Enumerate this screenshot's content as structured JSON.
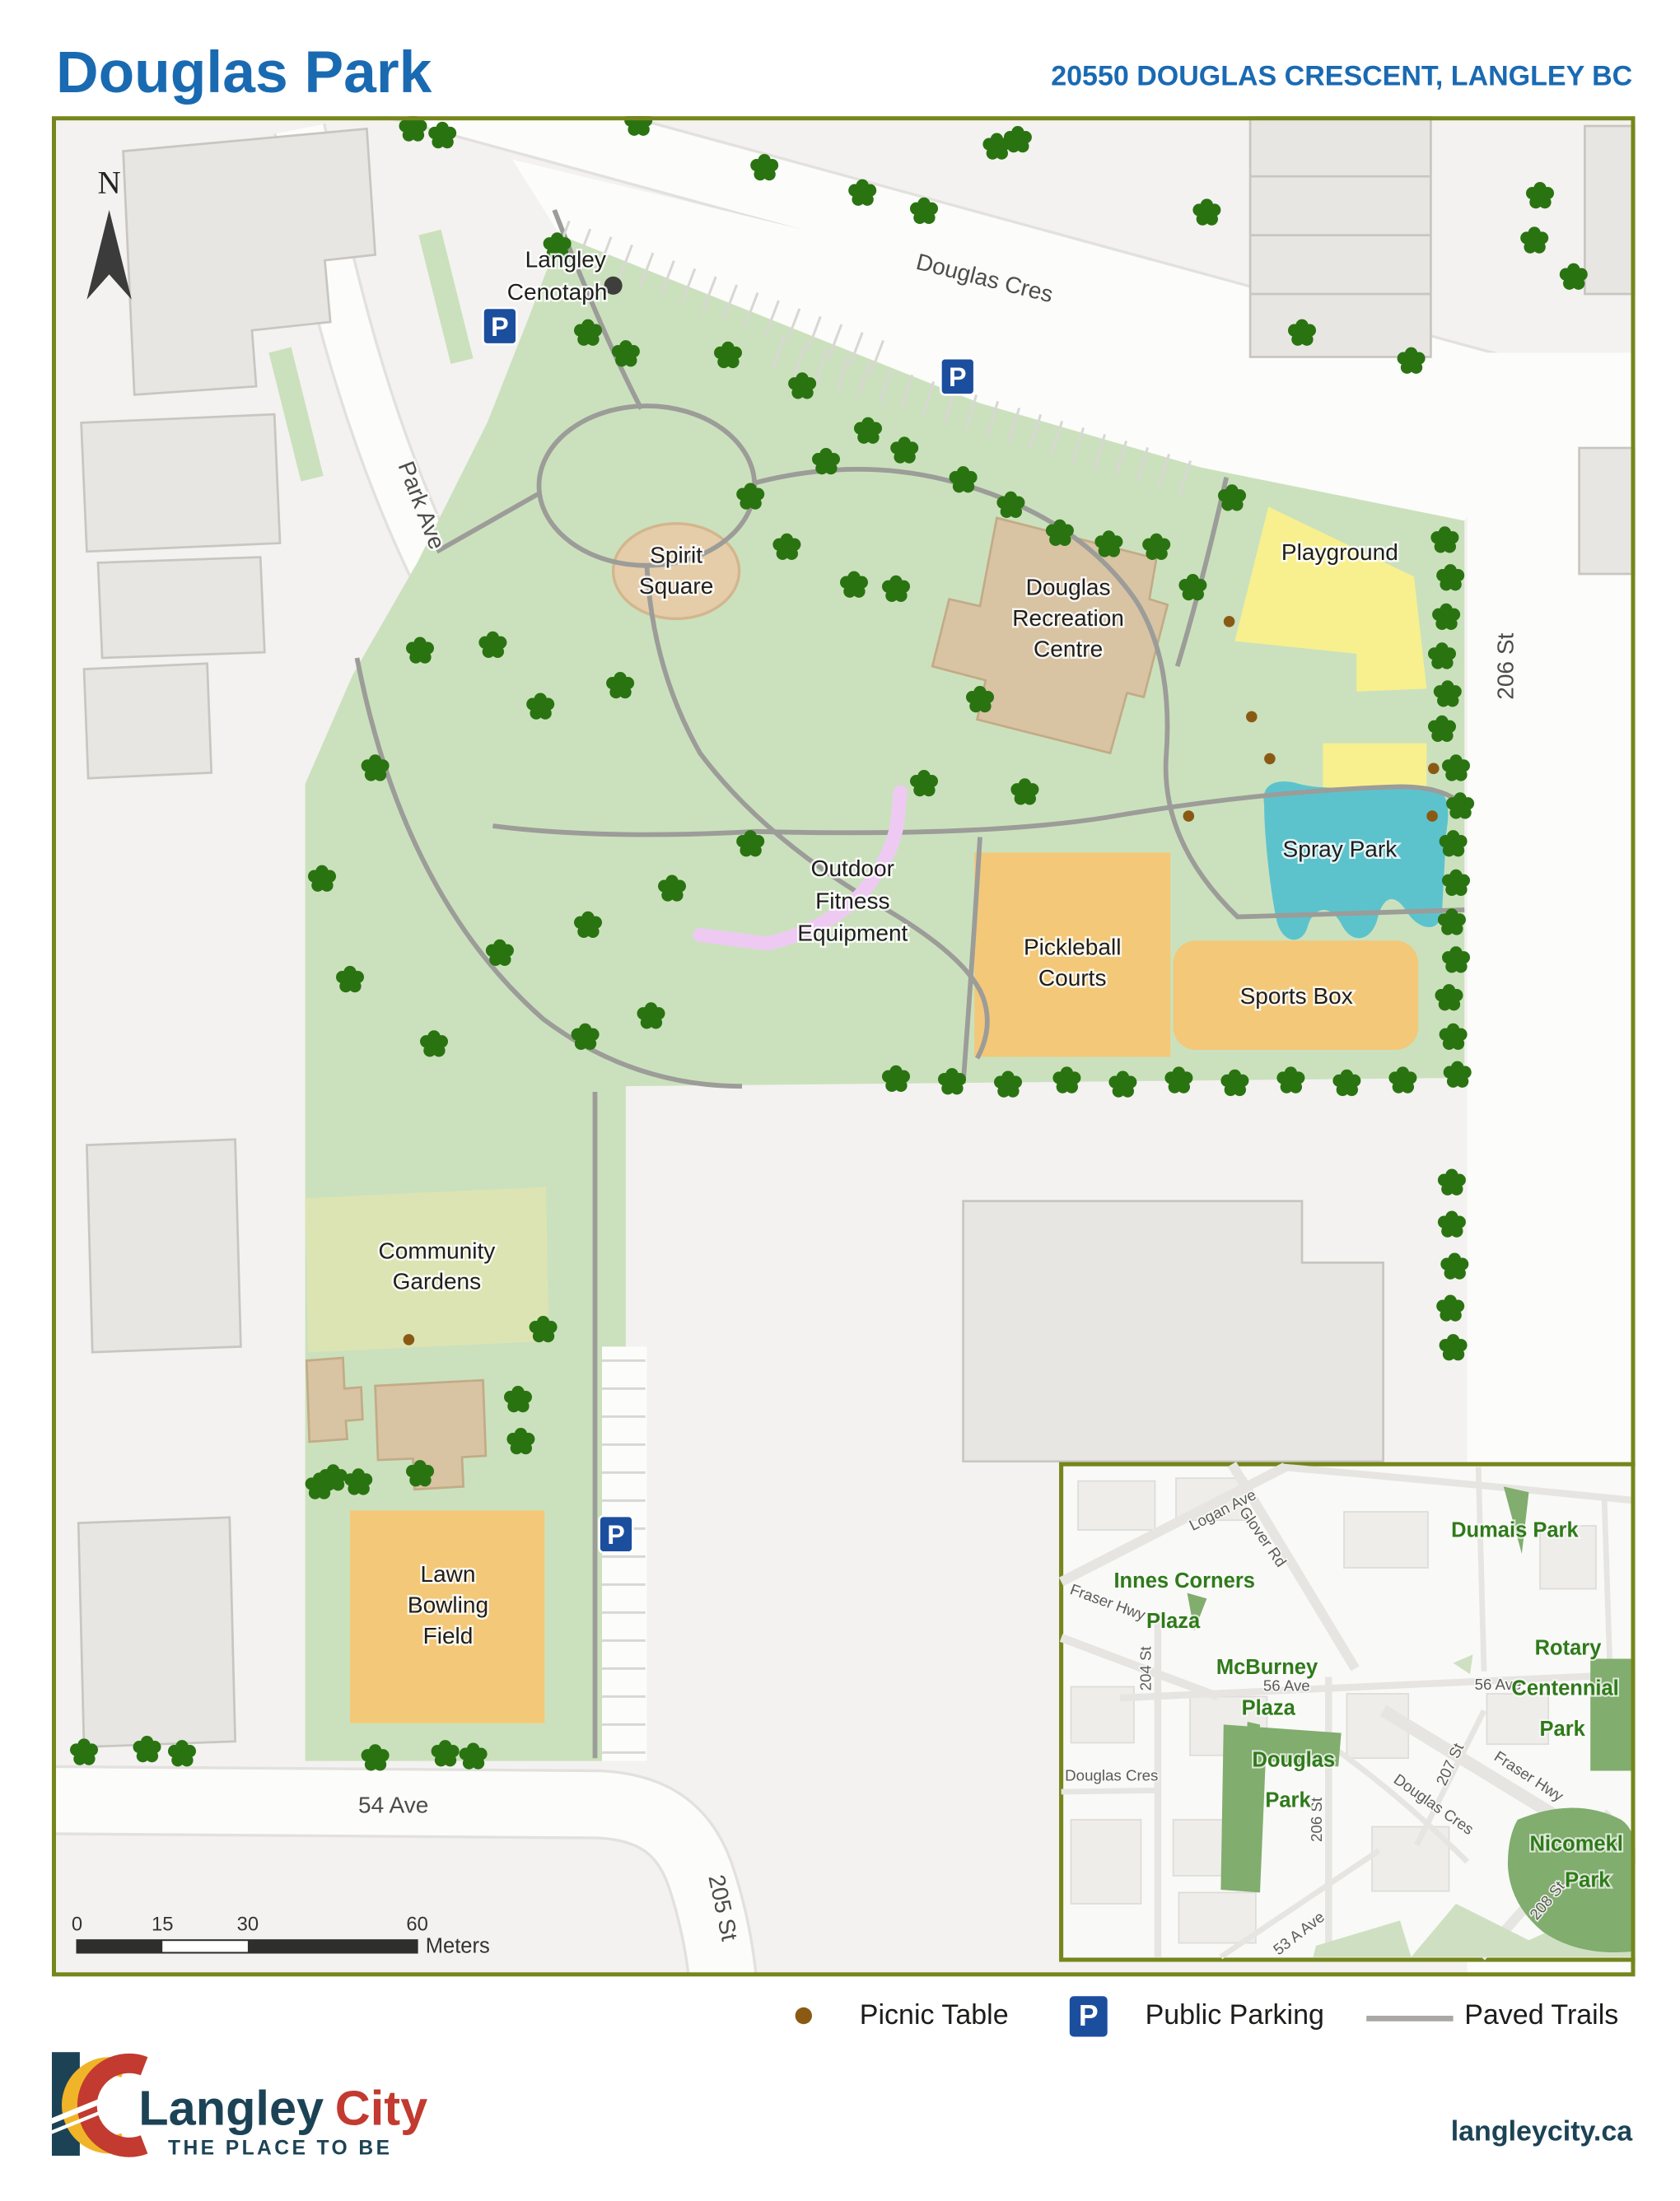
{
  "header": {
    "title": "Douglas Park",
    "address": "20550 DOUGLAS CRESCENT, LANGLEY BC"
  },
  "map": {
    "north": "N",
    "parking_symbol": "P",
    "streets": {
      "douglas_cres": "Douglas Cres",
      "park_ave": "Park Ave",
      "st_206": "206 St",
      "ave_54": "54 Ave",
      "st_205": "205 St"
    },
    "features": {
      "cenotaph": {
        "lines": [
          "Langley",
          "Cenotaph"
        ]
      },
      "spirit_square": {
        "lines": [
          "Spirit",
          "Square"
        ]
      },
      "rec_centre": {
        "lines": [
          "Douglas",
          "Recreation",
          "Centre"
        ]
      },
      "playground": {
        "label": "Playground"
      },
      "spray_park": {
        "label": "Spray Park"
      },
      "fitness": {
        "lines": [
          "Outdoor",
          "Fitness",
          "Equipment"
        ]
      },
      "pickleball": {
        "lines": [
          "Pickleball",
          "Courts"
        ]
      },
      "sports_box": {
        "label": "Sports Box"
      },
      "gardens": {
        "lines": [
          "Community",
          "Gardens"
        ]
      },
      "lawn_bowling": {
        "lines": [
          "Lawn",
          "Bowling",
          "Field"
        ]
      }
    },
    "scalebar": {
      "ticks": [
        "0",
        "15",
        "30",
        "60"
      ],
      "unit": "Meters"
    }
  },
  "inset": {
    "parks": [
      {
        "lines": [
          "Dumais Park"
        ]
      },
      {
        "lines": [
          "Innes Corners",
          "Plaza"
        ]
      },
      {
        "lines": [
          "McBurney",
          "Plaza"
        ]
      },
      {
        "lines": [
          "Douglas",
          "Park"
        ]
      },
      {
        "lines": [
          "Rotary",
          "Centennial",
          "Park"
        ]
      },
      {
        "lines": [
          "Nicomekl",
          "Park"
        ]
      }
    ],
    "streets": [
      "Logan Ave",
      "Glover Rd",
      "Fraser Hwy",
      "56 Ave",
      "56 Ave",
      "204 St",
      "Douglas Cres",
      "206 St",
      "Douglas Cres",
      "207 St",
      "Fraser Hwy",
      "53 A Ave",
      "208 St"
    ]
  },
  "legend": {
    "picnic": "Picnic Table",
    "parking": "Public Parking",
    "trails": "Paved Trails"
  },
  "footer": {
    "brand_primary": "Langley",
    "brand_accent": "City",
    "tagline": "THE PLACE TO BE",
    "url": "langleycity.ca"
  },
  "colors": {
    "titleBlue": "#1a6ab2",
    "frameOlive": "#76861c",
    "mapBg": "#f3f2f0",
    "street": "#fcfcfb",
    "casing": "#e2e1dd",
    "blockFill": "#eeedea",
    "blockLine": "#dddcd8",
    "building": "#e8e6e2",
    "buildingLine": "#c9c6c1",
    "parkGreen": "#cbe1bd",
    "gardenGreen": "#dde4b3",
    "tan": "#d8c3a3",
    "tanLine": "#c3ab87",
    "spiritTan": "#e5cda9",
    "yellow": "#f8f08e",
    "teal": "#5cc3cd",
    "orange": "#f3c878",
    "violet": "#eecaf3",
    "trail": "#9c9c99",
    "tree": "#2a7311",
    "picnic": "#8a5a14",
    "parkingBlue": "#1c4e9e",
    "labelDark": "#1e1e1c",
    "streetLabel": "#4c4c4a",
    "insetParkFill": "#81ad6e",
    "insetPale": "#cfe0c2",
    "insetGreenText": "#2f7a1b",
    "insetRoad": "#e6e5e1",
    "logoTeal": "#1c4355",
    "logoRed": "#c23a30",
    "logoYellow": "#f0b429",
    "scaleDark": "#2e2e2c"
  }
}
